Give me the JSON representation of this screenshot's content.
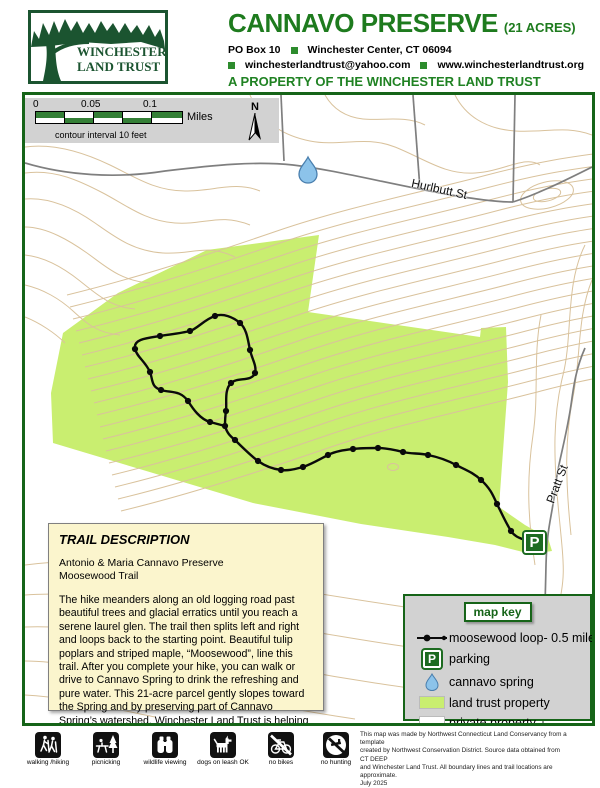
{
  "colors": {
    "brand_green": "#1e7b1e",
    "logo_green": "#1b5430",
    "map_border_green": "#166418",
    "land_trust_green": "#c9ee70",
    "contour_tan": "#d9c29c",
    "road_gray": "#7f7f7f",
    "spring_blue": "#8cc3ea",
    "desc_cream": "#fbf5cd",
    "key_gray": "#d2d2d2"
  },
  "header": {
    "logo_line1": "WINCHESTER",
    "logo_line2": "LAND TRUST",
    "title": "CANNAVO PRESERVE",
    "title_suffix": "(21 ACRES)",
    "po_box": "PO Box 10",
    "city": "Winchester Center, CT 06094",
    "email": "winchesterlandtrust@yahoo.com",
    "website": "www.winchesterlandtrust.org",
    "property_line": "A PROPERTY OF THE WINCHESTER LAND TRUST"
  },
  "map": {
    "scale": {
      "tick0": "0",
      "tick1": "0.05",
      "tick2": "0.1",
      "unit": "Miles",
      "contour_note": "contour interval 10 feet",
      "north_label": "N"
    },
    "roads": {
      "hurlbutt": "Hurlbutt St",
      "pratt": "Pratt St"
    },
    "parking_symbol": "P"
  },
  "trail_description": {
    "title": "TRAIL DESCRIPTION",
    "line1": "Antonio & Maria Cannavo Preserve",
    "line2": "Moosewood Trail",
    "body": "The hike meanders along an old logging road past beautiful trees and glacial erratics until you reach a serene laurel glen. The trail then splits left and right and loops back to the starting point. Beautiful tulip poplars and striped maple, “Moosewood”, line this trail. After you complete your hike, you can walk or drive to Cannavo Spring to drink the refreshing and pure water. This 21-acre parcel gently slopes toward the Spring and by preserving part of Cannavo Spring’s watershed, Winchester Land Trust is helping to keep the water clean."
  },
  "map_key": {
    "title": "map key",
    "items": [
      {
        "label": "moosewood loop- 0.5 miles"
      },
      {
        "label": "parking"
      },
      {
        "label": "cannavo spring"
      },
      {
        "label": "land trust property"
      },
      {
        "label": "private property"
      }
    ]
  },
  "footer": {
    "activities": [
      {
        "label": "walking /hiking"
      },
      {
        "label": "picnicking"
      },
      {
        "label": "wildlife viewing"
      },
      {
        "label": "dogs on leash OK"
      },
      {
        "label": "no bikes"
      },
      {
        "label": "no hunting"
      }
    ],
    "credit_lines": [
      "This map was made by Northwest Connecticut Land Conservancy from a template",
      "created by Northwest Conservation District. Source data obtained from CT DEEP",
      "and Winchester Land Trust. All boundary lines and trail locations are approximate.",
      "July 2025"
    ]
  }
}
